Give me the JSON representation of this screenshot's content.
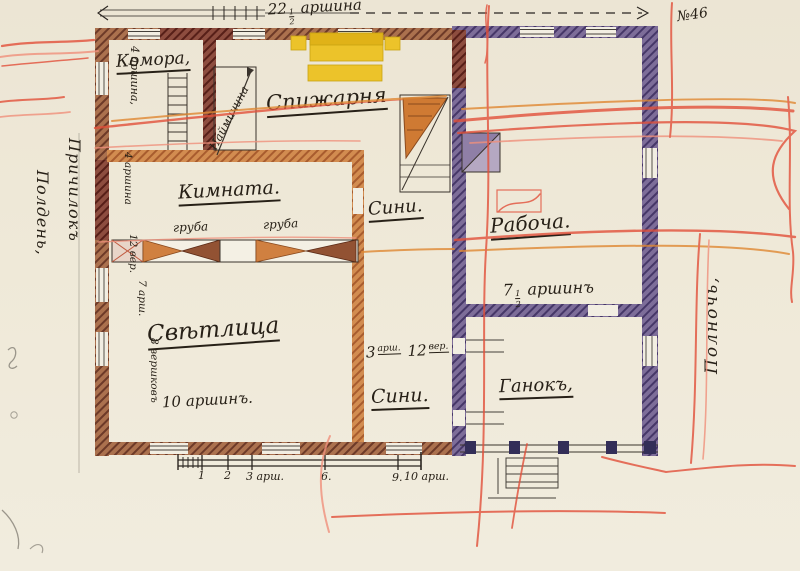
{
  "sheet": {
    "number": "№46"
  },
  "margins": {
    "south": "Полдень,",
    "side_inner": "Причилокъ",
    "north": "Полночь,"
  },
  "top_dimension": {
    "whole": "22",
    "num": "1",
    "den": "2",
    "unit": "аршина"
  },
  "rooms": {
    "komora": "Комора,",
    "spizharnia": "Спижарня",
    "naimychyna": "Наймичина",
    "kimnata": "Кимната.",
    "siny_upper": "Сини.",
    "rabocha": "Рабоча.",
    "svitlytsia": "Свѣтлица",
    "siny_lower": "Сини.",
    "ganok": "Ганокъ,"
  },
  "dimensions": {
    "komora_height": "4 аршина,",
    "wall_seg_1": "4 аршина",
    "wall_seg_2": "12 вер.",
    "wall_seg_3": "7 арш.",
    "wall_seg_4": "8 вершковъ",
    "svitlytsia_width": "10 аршинъ.",
    "rabocha": {
      "whole": "7",
      "num": "1",
      "den": "2",
      "unit": "аршинъ"
    },
    "siny_size": {
      "n1": "3",
      "u1": "арш.",
      "n2": "12",
      "u2": "вер."
    }
  },
  "stoves": {
    "left": "груба",
    "right": "груба"
  },
  "scale_bar": {
    "labels": [
      "1",
      "2",
      "3 арш.",
      "6.",
      "9.",
      "10 арш."
    ]
  }
}
